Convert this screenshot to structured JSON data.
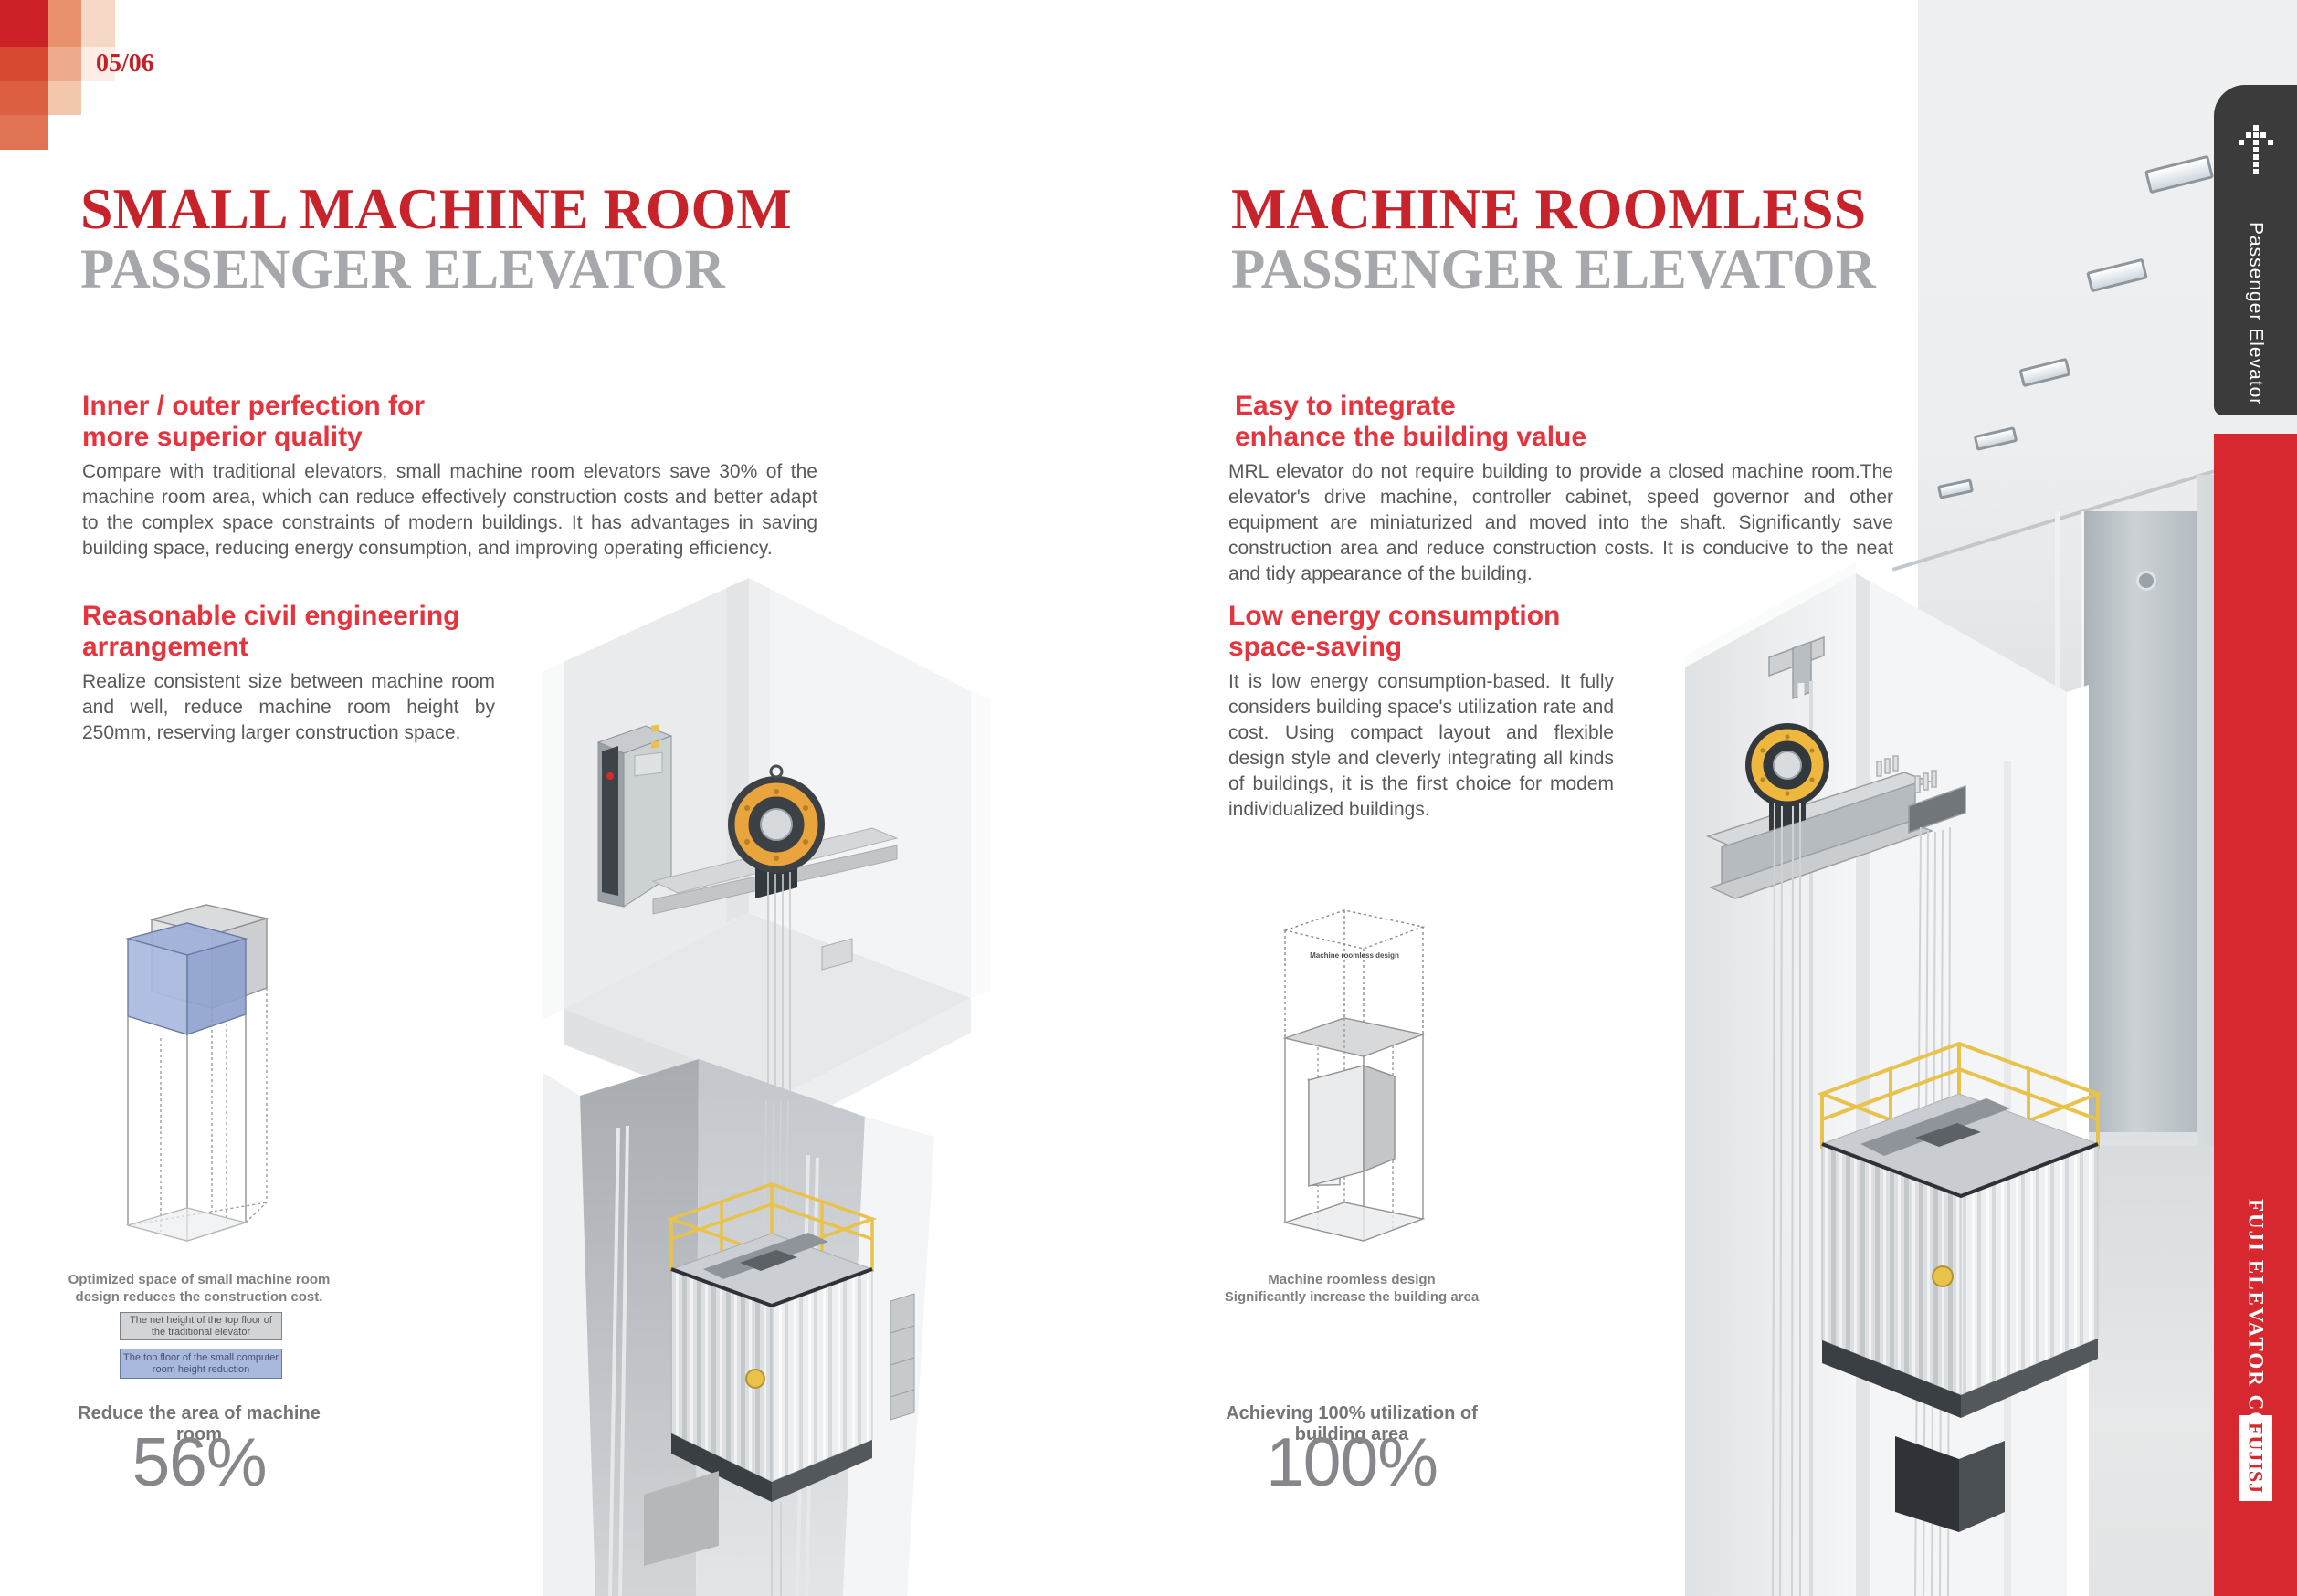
{
  "page": {
    "number": "05/06"
  },
  "brand": {
    "tab_label": "Passenger Elevator",
    "company": "FUJI ELEVATOR CO.,LTD",
    "logo": "FUJISJ",
    "colors": {
      "tab_dark": "#3b3b3b",
      "bar_red": "#d8282f"
    }
  },
  "colors": {
    "title_red": "#c8232b",
    "title_gray": "#a6a8ab",
    "heading_red": "#e5343e",
    "body_gray": "#58595b",
    "diagram_blue": "#a9b9de",
    "diagram_gray": "#d2d4d6",
    "railing_yellow": "#e8c24a",
    "sheave_orange": "#e9a43d"
  },
  "left": {
    "title_line1": "SMALL MACHINE ROOM",
    "title_line2": "PASSENGER ELEVATOR",
    "features": [
      {
        "heading1": "Inner / outer perfection for",
        "heading2": "more superior quality",
        "body": "Compare with traditional elevators, small machine room elevators save 30% of the machine room area, which can reduce effectively construction costs and better adapt to the complex space constraints of modern buildings. It has advantages in saving building space, reducing energy consumption, and improving operating efficiency."
      },
      {
        "heading1": "Reasonable civil engineering",
        "heading2": "arrangement",
        "body": "Realize consistent size between machine room and well, reduce machine room height by 250mm, reserving larger construction space."
      }
    ],
    "diagram": {
      "caption1": "Optimized space of small machine room",
      "caption2": "design reduces the construction cost.",
      "legend_traditional": "The net height of the top floor of the traditional elevator",
      "legend_small": "The top floor of the small computer room height reduction",
      "stat_label": "Reduce the area of machine room",
      "stat_value": "56%"
    }
  },
  "right": {
    "title_line1": "MACHINE ROOMLESS",
    "title_line2": "PASSENGER ELEVATOR",
    "features": [
      {
        "heading1": "Easy to integrate",
        "heading2": "enhance the building value",
        "body": "MRL elevator do not require building to provide a closed machine room.The elevator's drive machine, controller cabinet, speed governor and other equipment are miniaturized and moved into the shaft. Significantly save construction area and reduce construction costs. It is conducive to the neat and tidy appearance of the building."
      },
      {
        "heading1": "Low energy consumption",
        "heading2": "space-saving",
        "body": "It is low energy consumption-based. It fully considers building space's utilization rate and cost. Using compact layout and flexible design style and cleverly integrating all kinds of buildings, it is the first choice for modem individualized buildings."
      }
    ],
    "diagram": {
      "inner_label": "Machine roomless design",
      "caption1": "Machine roomless design",
      "caption2": "Significantly increase the building area",
      "stat_label": "Achieving 100% utilization of building area",
      "stat_value": "100%"
    }
  }
}
